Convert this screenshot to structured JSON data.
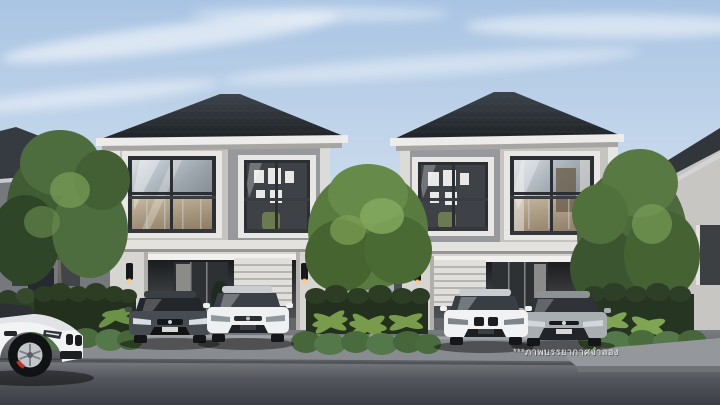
{
  "scene": {
    "type": "architectural-exterior-render",
    "description": "Photorealistic rendering of two identical two-storey detached houses with dark hipped roofs, glass upper windows with balustrades, ground-floor carports with parked sedans, clipped hedges, ornamental trees and an asphalt street in the foreground under a pale blue sky.",
    "watermark": "***ภาพบรรยากาศจำลอง"
  },
  "objects": {
    "house_left": "two-storey house with hipped roof and carport",
    "house_right": "two-storey house with hipped roof and carport",
    "cars": [
      "white sedan parked on street, foreground left",
      "dark grey sedan in left carport",
      "white sedan in left carport",
      "white sedan in right carport",
      "silver sedan in right carport"
    ]
  },
  "colors": {
    "sky_top": "#a9c4e3",
    "sky_bottom": "#e6edf4",
    "cloud": "#ffffff",
    "roof_light": "#3d444b",
    "roof_dark": "#1e2226",
    "fascia": "#edecea",
    "wall_light": "#c6c4c1",
    "wall_accent": "#98999c",
    "wall_bg": "#75787d",
    "window_frame": "#2b2e32",
    "interior_dark": "#3e4145",
    "interior_warm": "#c7a87c",
    "hedge_dark": "#22301d",
    "hedge_light": "#4a6b3d",
    "palm_green": "#7da24e",
    "tree_green": "#55713f",
    "apron": "#888b90",
    "planter": "#94979c",
    "road_light": "#797c81",
    "road_dark": "#3b3e44",
    "car_white": "#eef0f2",
    "car_dark": "#474c53",
    "car_silver": "#a9aeb3",
    "brake_red": "#c03228",
    "sconce_glow": "#ffc98a",
    "watermark_text": "#ffffff"
  }
}
